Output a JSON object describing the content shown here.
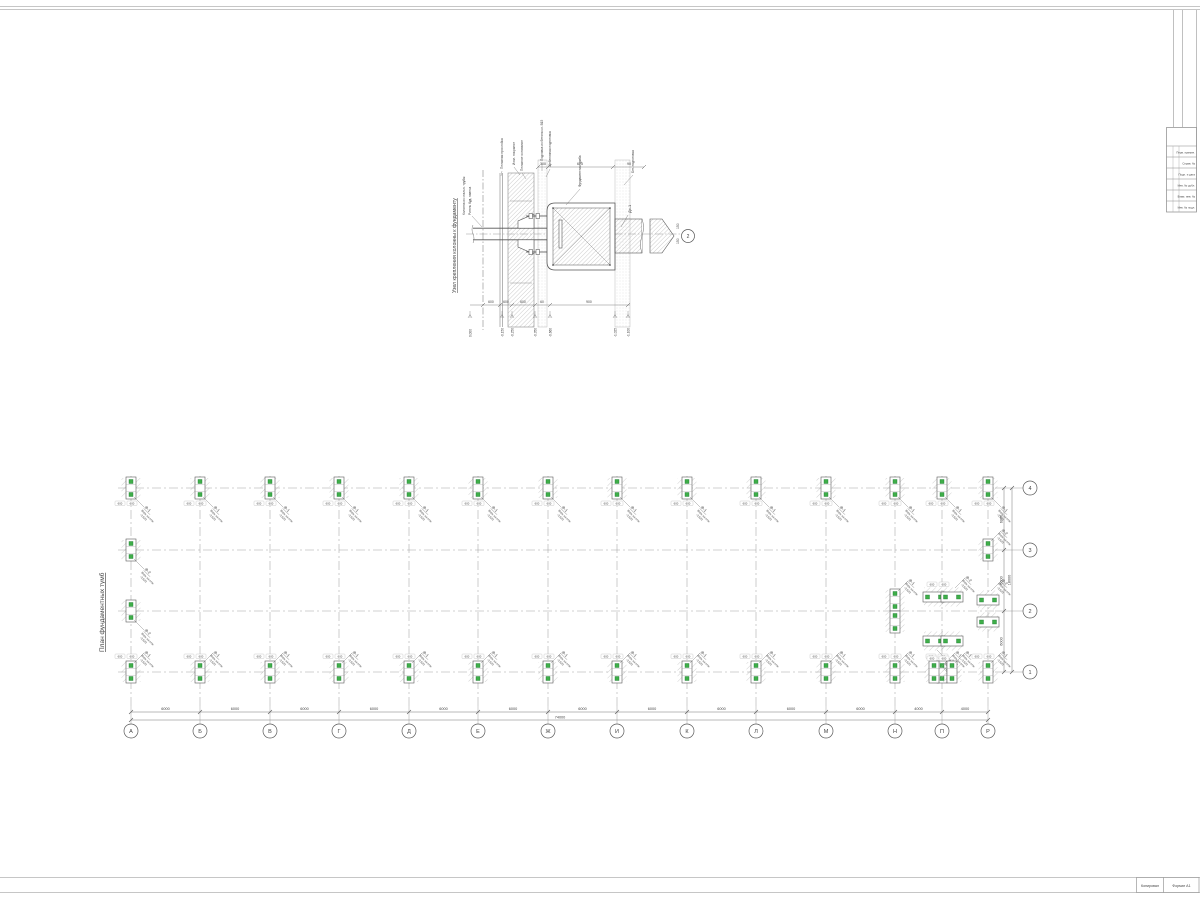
{
  "sheet": {
    "line_color": "#5a5a5a",
    "thin_color": "#9a9a9a",
    "green": "#3fae49"
  },
  "detail": {
    "title": "Узел крепления колонны к фундаменту",
    "section_bubble": "2",
    "section_mark": "Дс-1",
    "top_labels": [
      "Песчаная прослойка",
      "Изол. покрытие",
      "Песчаное основание",
      "Подливка из бетона кл. В15",
      "Щебеночная подготовка",
      "Фундаментная тумба",
      "Бет. подготовка"
    ],
    "left_labels": [
      "Колонна из стальн. трубы",
      "Ригель буд. навеса"
    ],
    "top_dims": [
      "300",
      "625",
      "90"
    ],
    "bottom_dims": [
      "600",
      "600",
      "600",
      "60",
      "900"
    ],
    "side_dims": [
      "150",
      "150"
    ],
    "elevations": [
      "0.000",
      "-0.150",
      "-0.250",
      "-0.350",
      "-0.660",
      "-1.025",
      "-1.100"
    ]
  },
  "plan": {
    "title": "План фундаментных тумб",
    "column_axes": [
      "А",
      "Б",
      "В",
      "Г",
      "Д",
      "Е",
      "Ж",
      "И",
      "К",
      "Л",
      "М",
      "Н",
      "П",
      "Р"
    ],
    "column_bay_dims": [
      "6000",
      "6000",
      "6000",
      "6000",
      "6000",
      "6000",
      "6000",
      "6000",
      "6000",
      "6000",
      "6000",
      "4000",
      "4000"
    ],
    "overall_length": "74000",
    "row_axes_top_to_bottom": [
      "4",
      "3",
      "2",
      "1"
    ],
    "row_bay_dims": [
      "6000",
      "6000",
      "6000"
    ],
    "overall_height": "18000",
    "foundation_marks": {
      "f1": "Ф-1",
      "f2": "Ф-2"
    },
    "elevation_note": "Верх на отм.",
    "elevation_value": "-0.620",
    "symbol_dims": [
      "600",
      "600"
    ]
  },
  "margin_block": {
    "rows": [
      "Перв. примен.",
      "Справ. №",
      "Подп. и дата",
      "Инв. № дубл.",
      "Взам. инв. №",
      "Инв. № подл."
    ]
  },
  "stamp": {
    "left": "Копировал",
    "right": "Формат А1"
  }
}
